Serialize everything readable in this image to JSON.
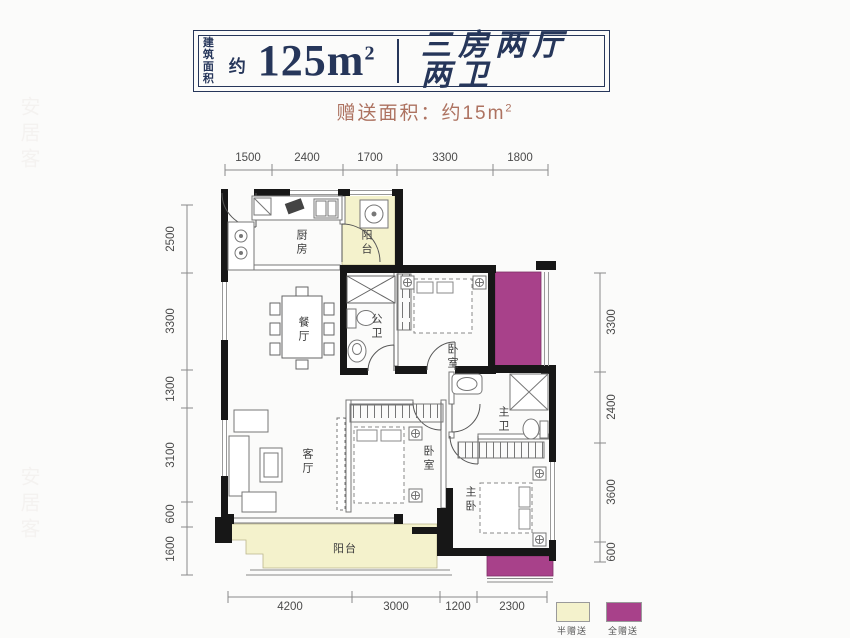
{
  "header": {
    "area_prefix_line1": "建筑",
    "area_prefix_line2": "面积",
    "approx": "约",
    "area_value": "125m",
    "area_sup": "2",
    "layout_name": "三房两厅两卫"
  },
  "subtitle": {
    "text": "赠送面积：约15m",
    "sup": "2"
  },
  "rooms": {
    "kitchen": "厨房",
    "balcony_top": "阳台",
    "dining": "餐厅",
    "bath_public": "公卫",
    "bedroom_top": "卧室",
    "living": "客厅",
    "bedroom_mid": "卧室",
    "bath_master": "主卫",
    "master": "主卧",
    "balcony_bottom": "阳台"
  },
  "dimensions": {
    "top": [
      "1500",
      "2400",
      "1700",
      "3300",
      "1800"
    ],
    "left": [
      "2500",
      "3300",
      "1300",
      "3100",
      "600",
      "1600"
    ],
    "right": [
      "3300",
      "2400",
      "3600",
      "600"
    ],
    "bottom": [
      "4200",
      "3000",
      "1200",
      "2300"
    ]
  },
  "legend": {
    "half": "半赠送",
    "full": "全赠送"
  },
  "colors": {
    "half_gift": "#f4f2cc",
    "full_gift": "#a8418a",
    "title_navy": "#26365a",
    "subtitle_accent": "#ad7260"
  },
  "watermark": "安居客"
}
